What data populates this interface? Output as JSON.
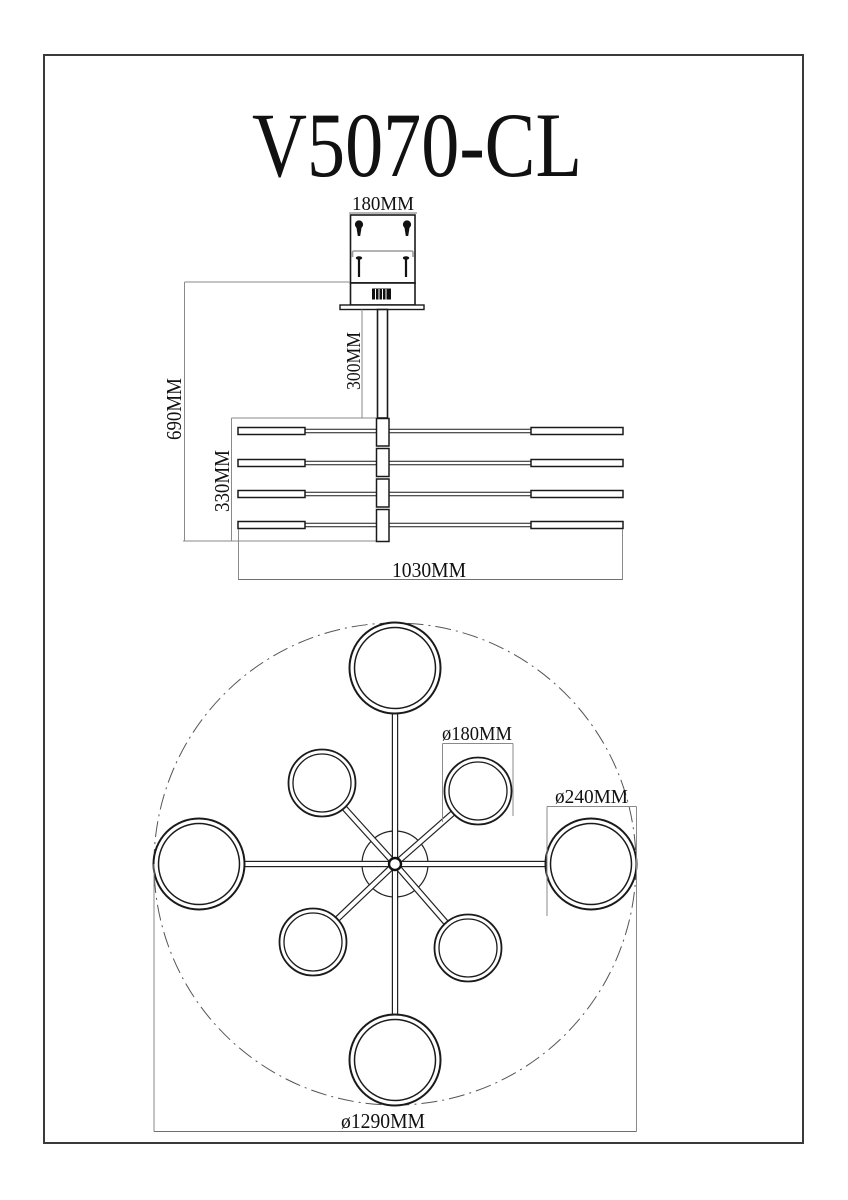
{
  "page": {
    "background": "#ffffff",
    "geometry_line_color": "#1a1a1a",
    "dimension_line_color": "#8a8a8a"
  },
  "drawing": {
    "title": "V5070-CL",
    "side_view": {
      "dims": {
        "canopy_width": "180MM",
        "stem_length": "300MM",
        "total_drop": "690MM",
        "arm_stack_height": "330MM",
        "overall_width": "1030MM"
      }
    },
    "plan_view": {
      "dims": {
        "small_ring_diameter": "ø180MM",
        "large_ring_diameter": "ø240MM",
        "overall_diameter": "ø1290MM"
      }
    }
  }
}
